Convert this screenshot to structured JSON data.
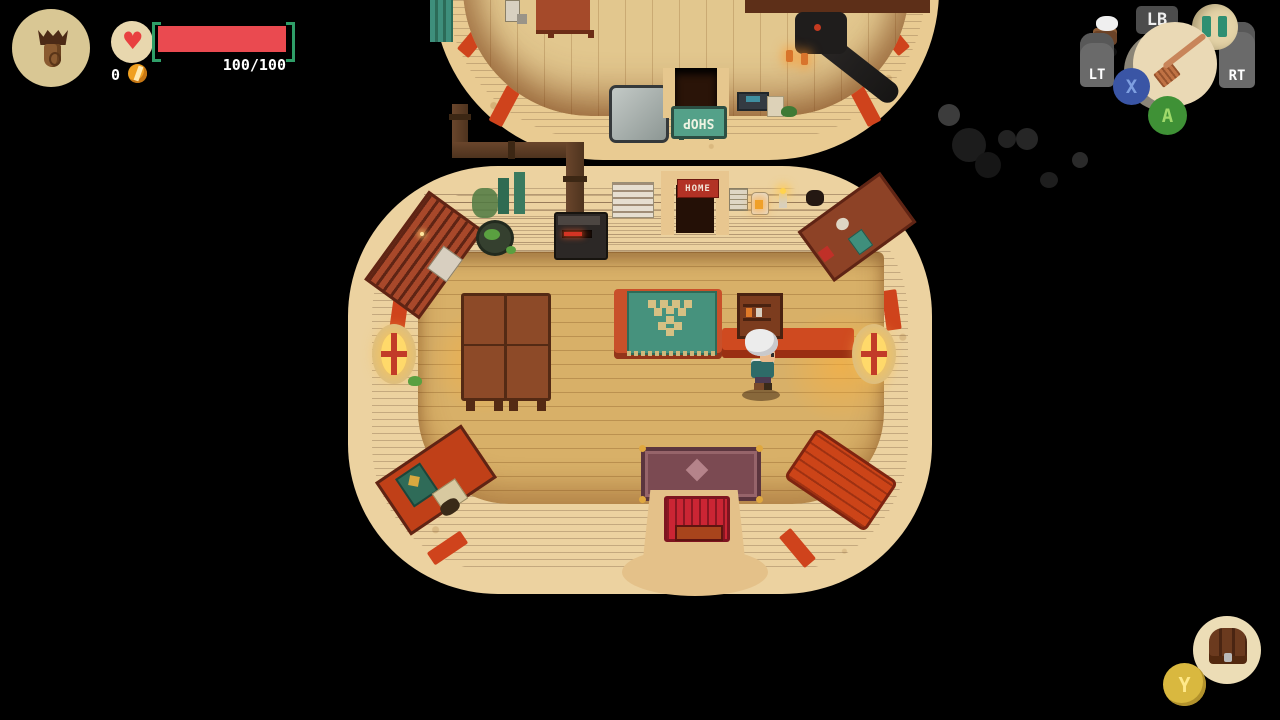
{
  "hud": {
    "health": {
      "display": "100/100"
    },
    "coins": "0",
    "buttons": {
      "lb": "LB",
      "lt": "LT",
      "rt": "RT",
      "x": "X",
      "a": "A",
      "y": "Y"
    },
    "heart_glyph": "♥"
  },
  "world": {
    "shop_sign": "SHOP",
    "home_sign": "HOME"
  },
  "icons": {
    "portrait": "pendant-icon",
    "equipped_item": "potion-bars-icon",
    "tool": "broom-icon",
    "inventory": "satchel-icon",
    "currency": "coin-icon"
  },
  "colors": {
    "health_red": "#ea4a50",
    "bracket_teal": "#2f9e68",
    "coin_gold": "#f0a020",
    "sign_teal": "#54a189",
    "home_sign_red": "#b23225",
    "button_x_blue": "#3a55a5",
    "button_a_green": "#3f9136",
    "button_y_gold": "#d9b83f",
    "floor_wood": "#d8b068",
    "ring_tan": "#ecd2a0"
  }
}
